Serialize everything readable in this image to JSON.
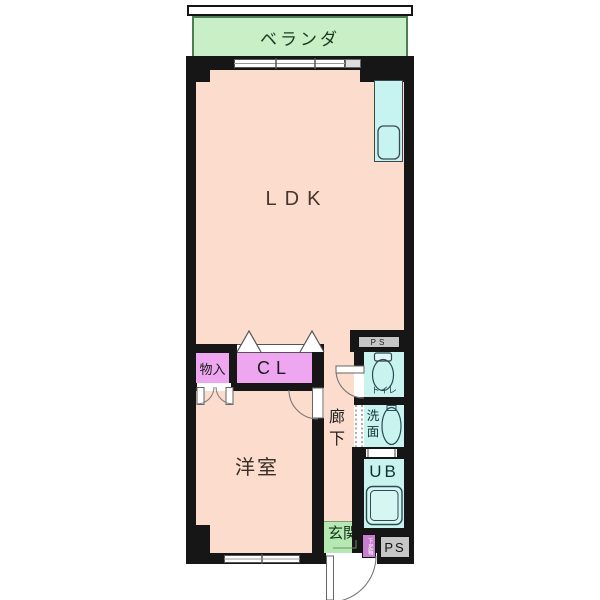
{
  "plan": {
    "balcony_label": "ベランダ",
    "ldk_label": "LDK",
    "storage_label": "物入",
    "closet_label": "CL",
    "western_room_label": "洋室",
    "corridor_char1": "廊",
    "corridor_char2": "下",
    "toilet_label": "トイレ",
    "wash_char1": "洗",
    "wash_char2": "面",
    "unit_bath_label": "UB",
    "entrance_label": "玄関",
    "shoe_cabinet_label": "下足箱",
    "pipe_space_top_label": "PS",
    "pipe_space_bottom_label": "PS"
  },
  "colors": {
    "wall": "#161616",
    "floor_pink": "#fbdccd",
    "veranda_green": "#c9efc7",
    "entrance_green": "#b5e9b1",
    "wet_area_cyan": "#c8f3ef",
    "closet_purple": "#eda6ef",
    "shoe_cabinet_purple": "#c97fd0",
    "pipe_space_gray": "#c6c6c6"
  }
}
